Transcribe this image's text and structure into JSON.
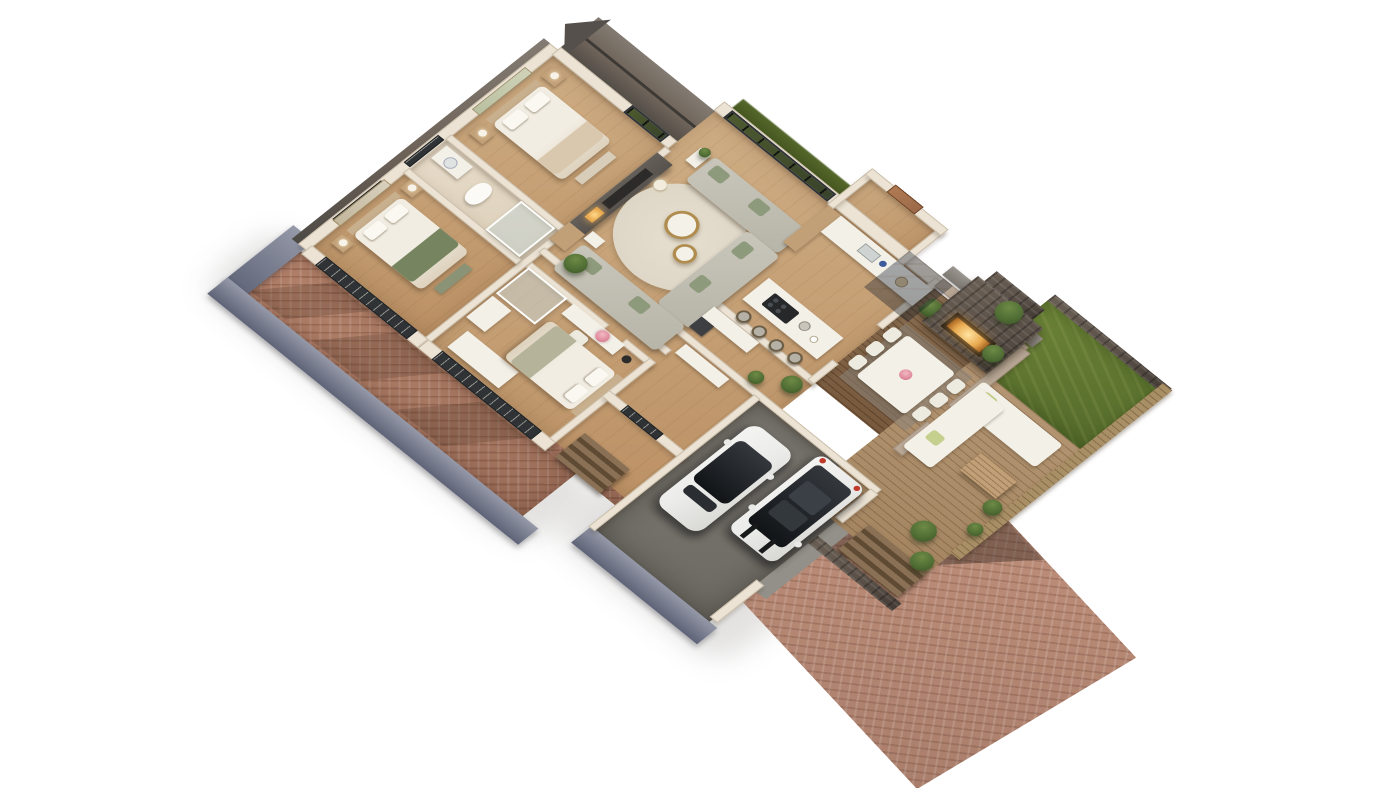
{
  "scene": {
    "kind": "3d-cutaway-floor-plan-render",
    "view": "oblique dollhouse aerial, roof removed, white background",
    "building": "single-storey house with courtyard patio, rear garden deck and double garage"
  },
  "colors": {
    "bg": "#ffffff",
    "wood": "#cfae85",
    "wood_dark": "#bb9064",
    "tile": "#e8ddcb",
    "wall": "#ece3d4",
    "wall_edge": "#c9bda9",
    "outer_wall": "#5e6377",
    "outer_wall_top": "#9599a8",
    "roof": "#6e6359",
    "roof_dark": "#4e4a45",
    "media": "#57524d",
    "media_screen": "#2d2b29",
    "fire": "#e8a94f",
    "sofa": "#c9c6bb",
    "cushion": "#8e9a7c",
    "rug": "#ded6c6",
    "gold": "#b08d4f",
    "bed": "#f2ede3",
    "bed_shadow": "#ddd2bd",
    "headboard": "#c8b08e",
    "throw": "#76855f",
    "wood_furn": "#c2a077",
    "glass": "#c6d2cf",
    "window": "#2f3336",
    "window_green": "#4d5a2e",
    "hedge": "#44561f",
    "grass1": "#6d8438",
    "grass2": "#52682a",
    "deck": "#b49674",
    "slat": "#8a6f52",
    "brick1": "#b5836c",
    "brick2": "#9c6f5a",
    "drive1": "#c2927d",
    "drive2": "#a97e6b",
    "stone": "#5a5048",
    "stucco": "#b9a896",
    "garage": "#7b7871",
    "concrete": "#929089",
    "car": "#ebebe9",
    "car_glass": "#1f2327",
    "fence": "#a98f66",
    "plant": "#4e6b33",
    "flower": "#e08a9b",
    "white_furn": "#f3f0e8",
    "copper": "#9c6a4a",
    "stool": "#b6b1a6"
  },
  "rooms": [
    {
      "name": "master-bedroom",
      "furniture": [
        "double bed",
        "tan headboard",
        "2 wood nightstands",
        "2 sphere table lamps",
        "landscape wall art",
        "foot bench"
      ]
    },
    {
      "name": "ensuite-bathroom",
      "furniture": [
        "toilet",
        "vanity with basin",
        "walk-in glass shower",
        "slatted window"
      ]
    },
    {
      "name": "bedroom-2",
      "furniture": [
        "double bed with green throw",
        "2 nightstands",
        "2 table lamps",
        "framed wall art",
        "green foot bench"
      ]
    },
    {
      "name": "bedroom-3",
      "furniture": [
        "double bed",
        "vanity desk",
        "white chair",
        "vase of pink roses",
        "wardrobe",
        "glass shower room",
        "black floor lamp"
      ]
    },
    {
      "name": "living-room",
      "furniture": [
        "charcoal media fireplace wall",
        "L corner sofa",
        "window sofa",
        "lounge sofa",
        "round cream rug",
        "2 brass round coffee tables",
        "floor lamp",
        "side table with coffee set",
        "potted plant",
        "glazed sliding wall"
      ]
    },
    {
      "name": "kitchen",
      "furniture": [
        "island with gas hob",
        "4 bar stools",
        "sink counter run",
        "tall wood cabinet",
        "kettle and crockery"
      ]
    },
    {
      "name": "entry-hall",
      "furniture": [
        "copper front door"
      ]
    },
    {
      "name": "utility-hall",
      "furniture": [
        "white counter",
        "dark appliance",
        "sideboard",
        "2 potted plants"
      ]
    },
    {
      "name": "garage",
      "furniture": [
        "two parked cars",
        "grey concrete floor"
      ]
    }
  ],
  "outdoor": [
    {
      "name": "courtyard-patio",
      "surface": "terracotta herringbone brick",
      "features": [
        "enclosing blue-grey walls",
        "window shadows",
        "steps"
      ]
    },
    {
      "name": "covered-veranda",
      "features": [
        "stacked-stone outdoor fireplace with lit firebox",
        "white dining table",
        "6 white chairs",
        "rose centerpiece",
        "slatted timber floor",
        "glazed roof panels"
      ]
    },
    {
      "name": "garden-deck",
      "features": [
        "white L outdoor sofa",
        "lime cushions",
        "slatted wood coffee table",
        "2 olive trees",
        "timber boards",
        "steps to driveway"
      ]
    },
    {
      "name": "lawn",
      "features": [
        "grass",
        "stone edging",
        "leafy plants"
      ]
    },
    {
      "name": "driveway",
      "surface": "herringbone brick",
      "features": [
        "garage shadow",
        "concrete apron"
      ]
    },
    {
      "name": "boundary",
      "features": [
        "timber slat fence",
        "shrubs"
      ]
    }
  ],
  "vehicles": [
    {
      "name": "car-left",
      "type": "crossover",
      "body": "white",
      "roof": "black glass"
    },
    {
      "name": "car-right",
      "type": "compact suv",
      "body": "white",
      "roof": "black twin sunroof, bonnet stripes, red tail lamps"
    }
  ]
}
